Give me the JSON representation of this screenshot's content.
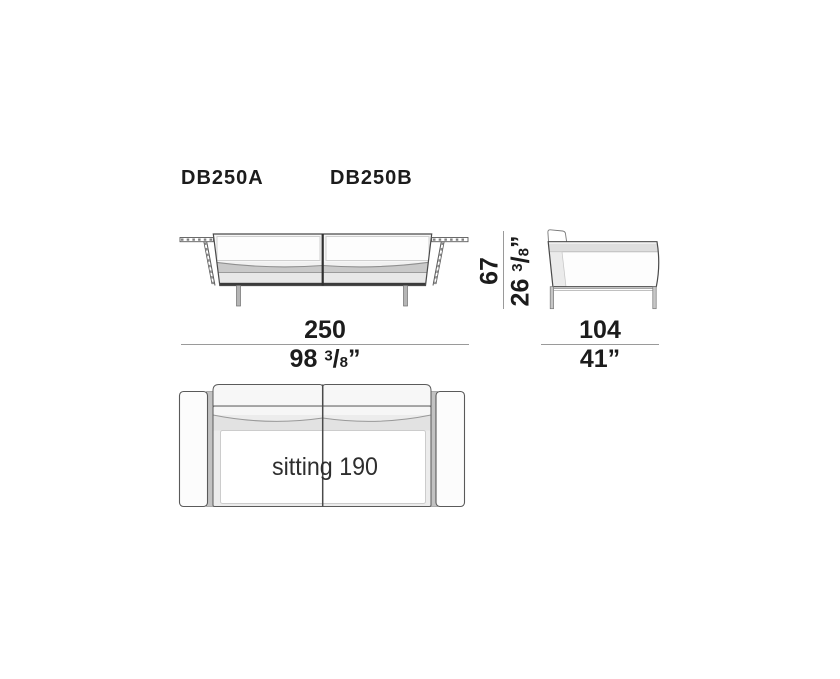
{
  "product": {
    "model_a": "DB250A",
    "model_b": "DB250B"
  },
  "dimensions": {
    "overall_width": {
      "cm": "250",
      "in_whole": "98",
      "frac_num": "3",
      "frac_slash": "/",
      "frac_den": "8",
      "inch_mark": "”"
    },
    "overall_depth": {
      "cm": "104",
      "in": "41”"
    },
    "overall_height": {
      "cm": "67",
      "in_whole": "26",
      "frac_num": "3",
      "frac_slash": "/",
      "frac_den": "8",
      "inch_mark": "”"
    },
    "seat": {
      "label": "sitting 190"
    }
  },
  "colors": {
    "background": "#ffffff",
    "outline_dark": "#4a4a4a",
    "outline_mid": "#8a8a8a",
    "dim_line": "#9a9a9a",
    "fill_light": "#f0f0f0",
    "fill_band": "#c9c9c9",
    "base_bar": "#3b3b3b",
    "text": "#1c1c1c"
  }
}
